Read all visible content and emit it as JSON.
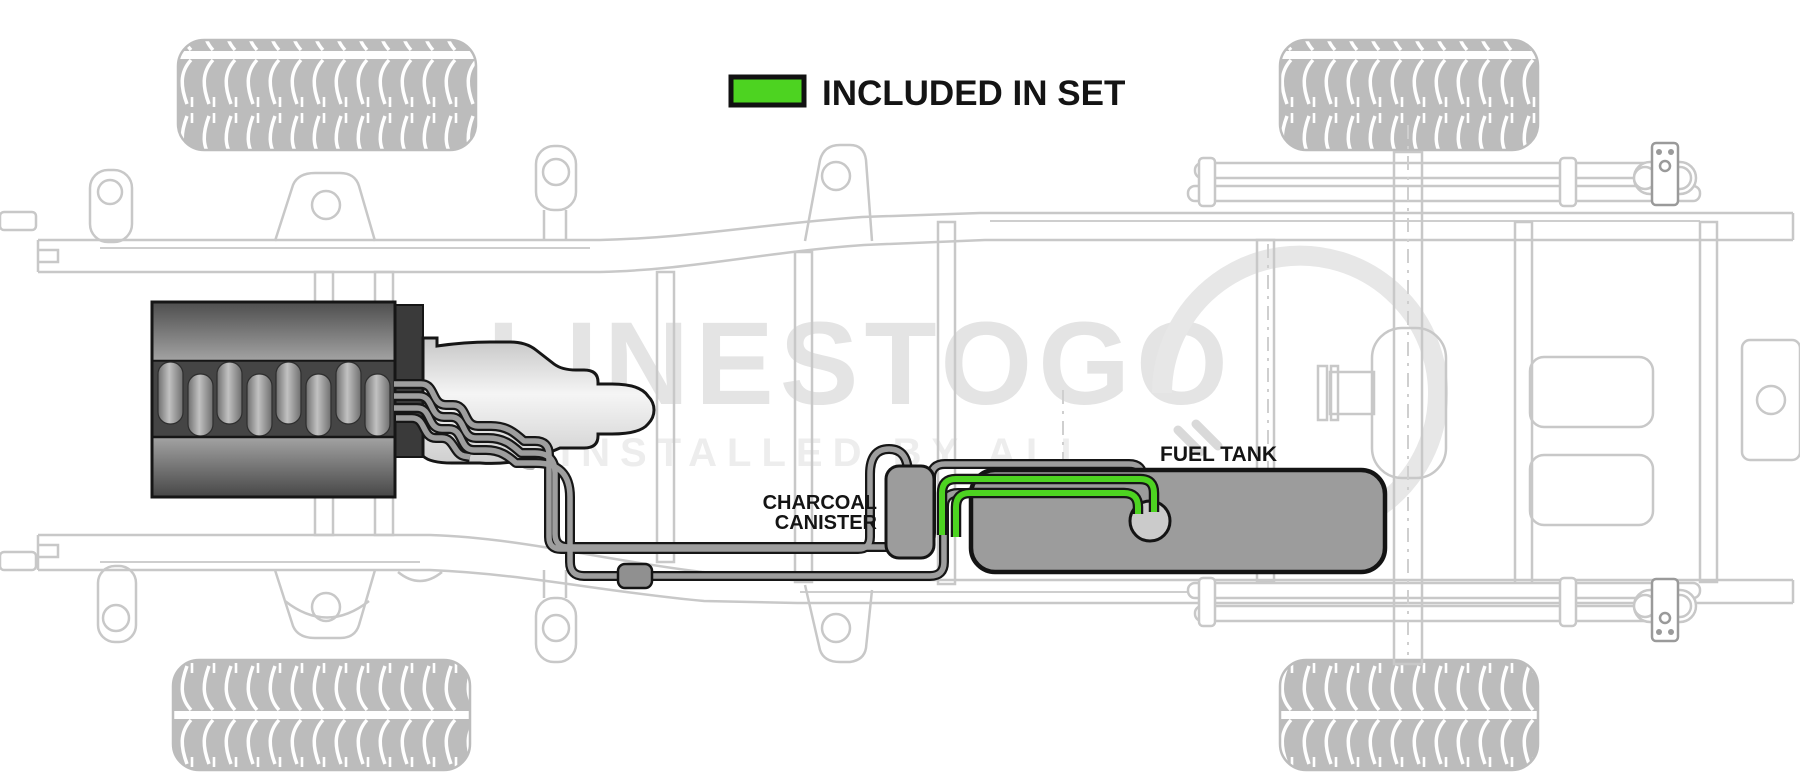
{
  "legend": {
    "label": "INCLUDED IN SET",
    "swatch_color": "#4dd321"
  },
  "labels": {
    "charcoal_canister": [
      "CHARCOAL",
      "CANISTER"
    ],
    "fuel_tank": "FUEL TANK"
  },
  "watermark": {
    "logo_text": "LINESTOGO",
    "tagline": "INSTALLED BY ALI"
  },
  "colors": {
    "included_green": "#4dd321",
    "line_gray": "#9e9e9e",
    "line_outline": "#161616",
    "tank_gray": "#9c9c9c",
    "canister_gray": "#9c9c9c",
    "sender_gray": "#cbcbcb",
    "chassis_gray": "#c8c8c8",
    "tire_gray": "#bcbcbc",
    "watermark_gray": "#e4e4e4",
    "label_black": "#141414"
  },
  "parts": [
    {
      "name": "engine",
      "style": "dark solid"
    },
    {
      "name": "transmission",
      "style": "light solid"
    },
    {
      "name": "fuel-lines",
      "count": 4,
      "style": "gray with black outline"
    },
    {
      "name": "charcoal-canister",
      "label": "CHARCOAL CANISTER"
    },
    {
      "name": "fuel-tank",
      "label": "FUEL TANK"
    },
    {
      "name": "fuel-sender-unit",
      "style": "circle on tank"
    },
    {
      "name": "included-lines",
      "style": "green highlighted fuel lines along tank"
    },
    {
      "name": "line-clamp",
      "style": "small gray block on lower line"
    },
    {
      "name": "truck-frame",
      "style": "light gray outline, top view"
    },
    {
      "name": "tires",
      "count": 4
    },
    {
      "name": "rear-axle-and-leaf-springs",
      "style": "light gray outline"
    }
  ]
}
